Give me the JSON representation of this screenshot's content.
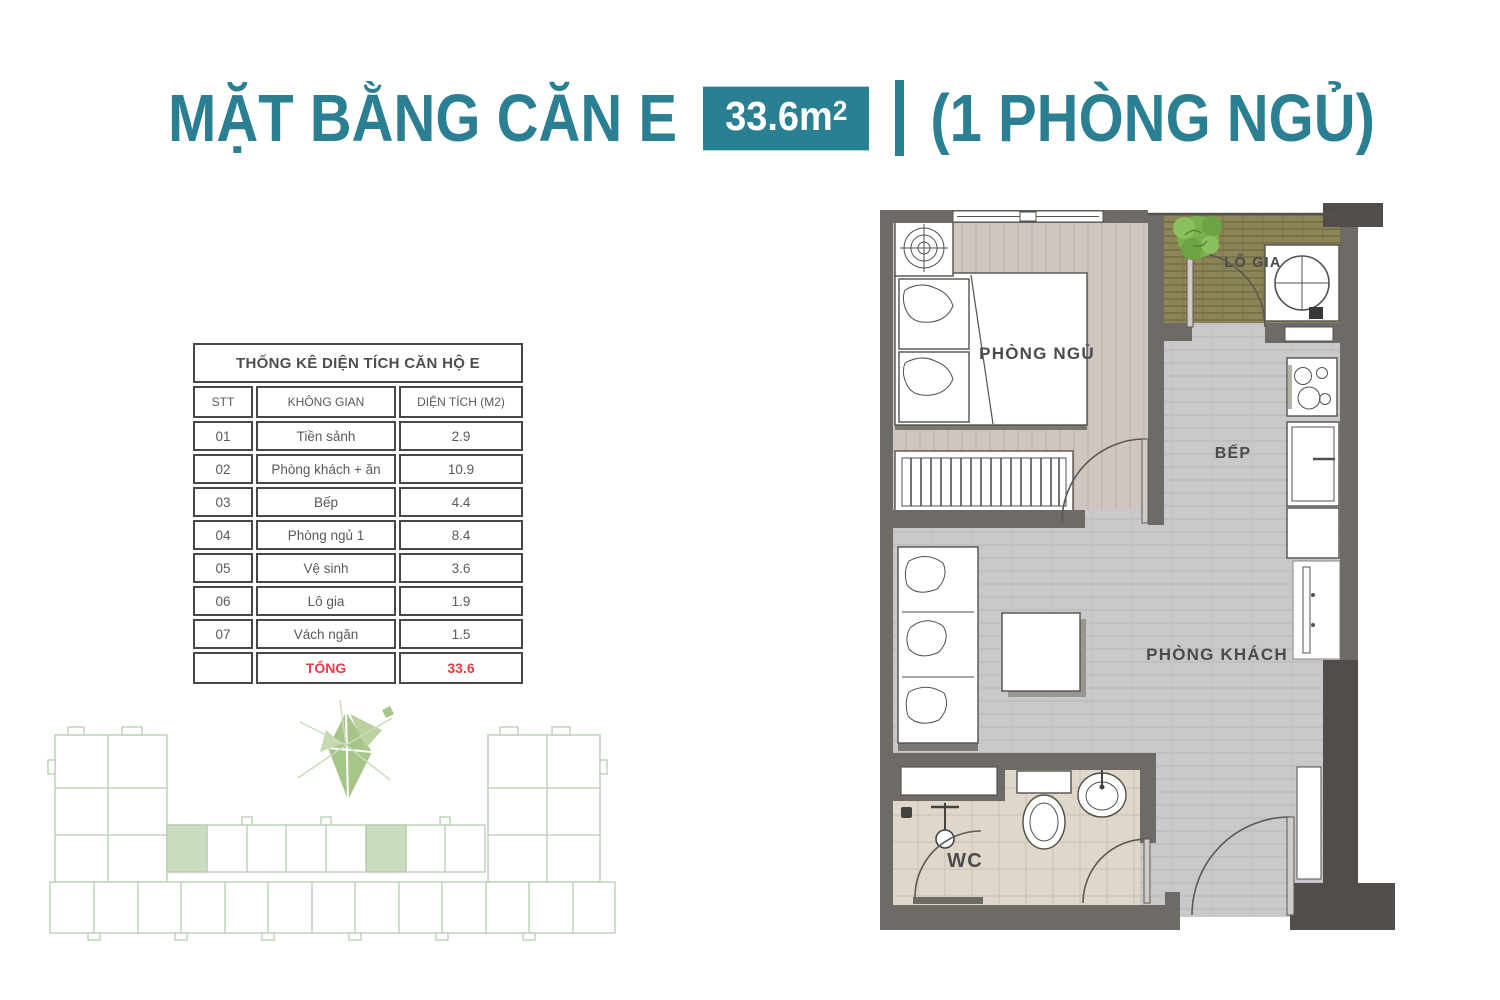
{
  "header": {
    "title": "MẶT BẰNG CĂN E",
    "area_value": "33.6m",
    "area_sup": "2",
    "subtitle": "(1 PHÒNG NGỦ)"
  },
  "colors": {
    "accent_teal": "#2a7f92",
    "total_red": "#e83c46",
    "wall_gray": "#6e6b67",
    "balcony_olive": "#8d8557",
    "keyplan_green": "#b6ccb1"
  },
  "area_table": {
    "title": "THỐNG KÊ DIỆN TÍCH CĂN HỘ E",
    "columns": [
      "STT",
      "KHÔNG GIAN",
      "DIỆN TÍCH (M2)"
    ],
    "rows": [
      {
        "stt": "01",
        "space": "Tiền sảnh",
        "area": "2.9"
      },
      {
        "stt": "02",
        "space": "Phòng khách + ăn",
        "area": "10.9"
      },
      {
        "stt": "03",
        "space": "Bếp",
        "area": "4.4"
      },
      {
        "stt": "04",
        "space": "Phòng ngủ 1",
        "area": "8.4"
      },
      {
        "stt": "05",
        "space": "Vệ sinh",
        "area": "3.6"
      },
      {
        "stt": "06",
        "space": "Lô gia",
        "area": "1.9"
      },
      {
        "stt": "07",
        "space": "Vách ngăn",
        "area": "1.5"
      }
    ],
    "total_label": "TỔNG",
    "total_value": "33.6"
  },
  "floor_plan": {
    "labels": {
      "bedroom": "PHÒNG NGỦ",
      "balcony": "LÔ GIA",
      "kitchen": "BẾP",
      "living": "PHÒNG KHÁCH",
      "wc": "WC"
    }
  }
}
